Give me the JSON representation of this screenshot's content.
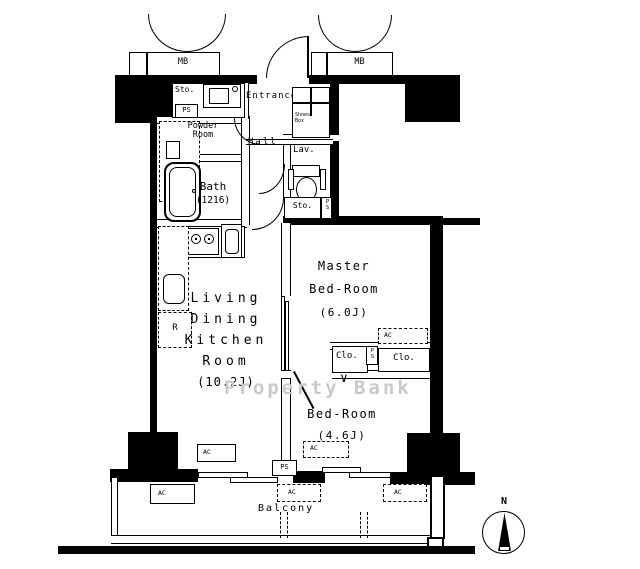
{
  "watermark": "Property Bank",
  "compass": {
    "north": "N"
  },
  "rooms": {
    "ldk": {
      "lines": [
        "Living",
        "Dining",
        "Kitchen",
        "Room"
      ],
      "size": "(10.2J)"
    },
    "master": {
      "lines": [
        "Master",
        "Bed-Room"
      ],
      "size": "(6.0J)"
    },
    "bedroom": {
      "name": "Bed-Room",
      "size": "(4.6J)"
    },
    "bath": {
      "name": "Bath",
      "size": "(1216)"
    },
    "powder": {
      "lines": [
        "Powder",
        "Room"
      ]
    },
    "entrance": "Entrance",
    "hall": "Hall",
    "lavatory": "Lav.",
    "balcony": "Balcony"
  },
  "labels": {
    "storage": "Sto.",
    "pipe_space": "PS",
    "meter_box": "MB",
    "closet": "Clo.",
    "air_con": "AC",
    "refrigerator": "R",
    "shoes_box": "Shoes Box"
  }
}
